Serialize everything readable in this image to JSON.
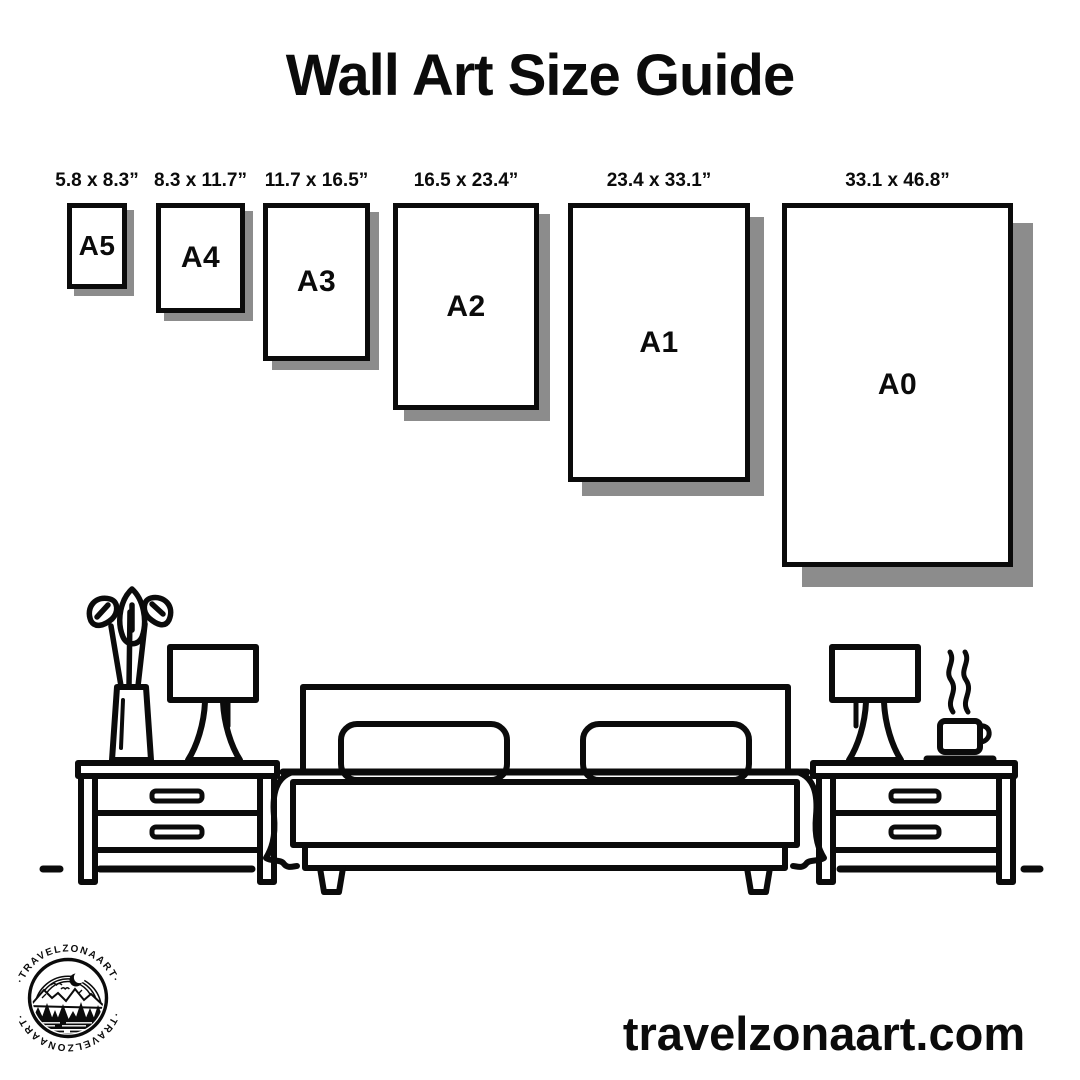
{
  "header": {
    "title": "Wall Art Size Guide"
  },
  "size_guide": {
    "items": [
      {
        "name": "A5",
        "dimensions": "5.8 x 8.3”"
      },
      {
        "name": "A4",
        "dimensions": "8.3 x 11.7”"
      },
      {
        "name": "A3",
        "dimensions": "11.7 x 16.5”"
      },
      {
        "name": "A2",
        "dimensions": "16.5 x 23.4”"
      },
      {
        "name": "A1",
        "dimensions": "23.4 x 33.1”"
      },
      {
        "name": "A0",
        "dimensions": "33.1 x 46.8”"
      }
    ]
  },
  "logo": {
    "brand": "TRAVELZONAART",
    "text_top": "·TRAVELZONAART·",
    "text_bottom": "·TRAVELZONAART·"
  },
  "footer": {
    "website": "travelzonaart.com"
  },
  "colors": {
    "ink": "#0b0b0b",
    "shadow": "#8c8c8c",
    "bg": "#ffffff"
  }
}
